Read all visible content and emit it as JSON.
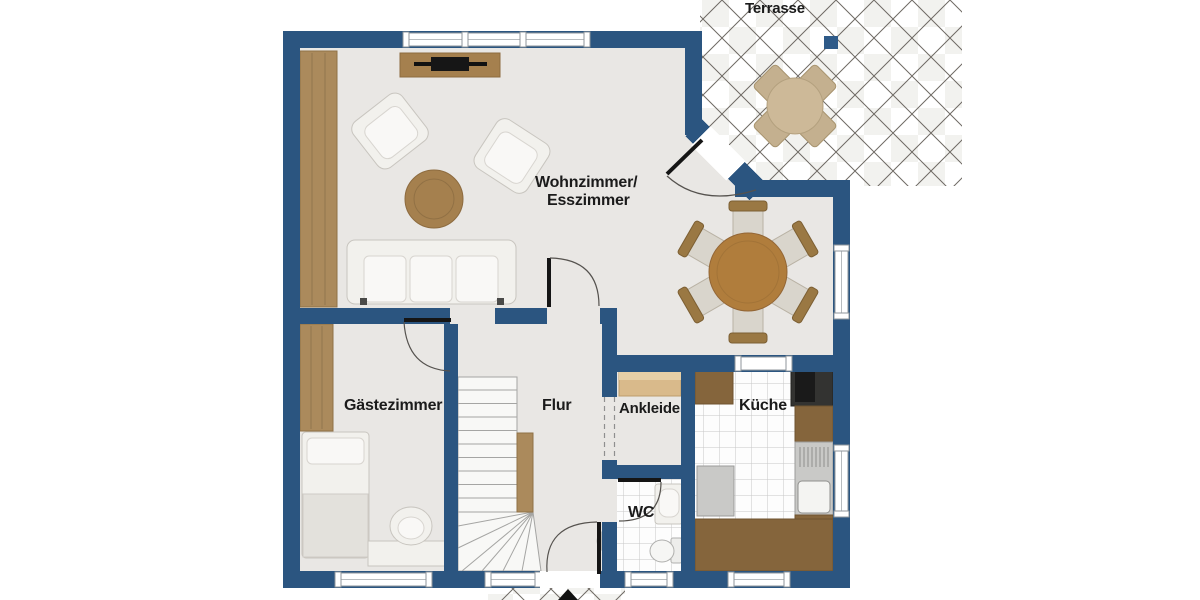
{
  "labels": {
    "terrasse": "Terrasse",
    "wohnzimmer_line1": "Wohnzimmer/",
    "wohnzimmer_line2": "Esszimmer",
    "gaestezimmer": "Gästezimmer",
    "flur": "Flur",
    "ankleide": "Ankleide",
    "wc": "WC",
    "kueche": "Küche"
  },
  "colors": {
    "wall": "#2b5580",
    "floor": "#e9e7e4",
    "wood_light": "#ab8a5c",
    "wood_board": "#a5804e",
    "dining_table": "#b07d3c",
    "kitchen_counter": "#85653c",
    "shelf_tan": "#d9ba8b",
    "terrace_wood": "#cdb998",
    "appliance_dark": "#333331",
    "white_furniture": "#f2f1ed",
    "accent_square": "#2e5a88",
    "label_text": "#1b1b1b"
  }
}
